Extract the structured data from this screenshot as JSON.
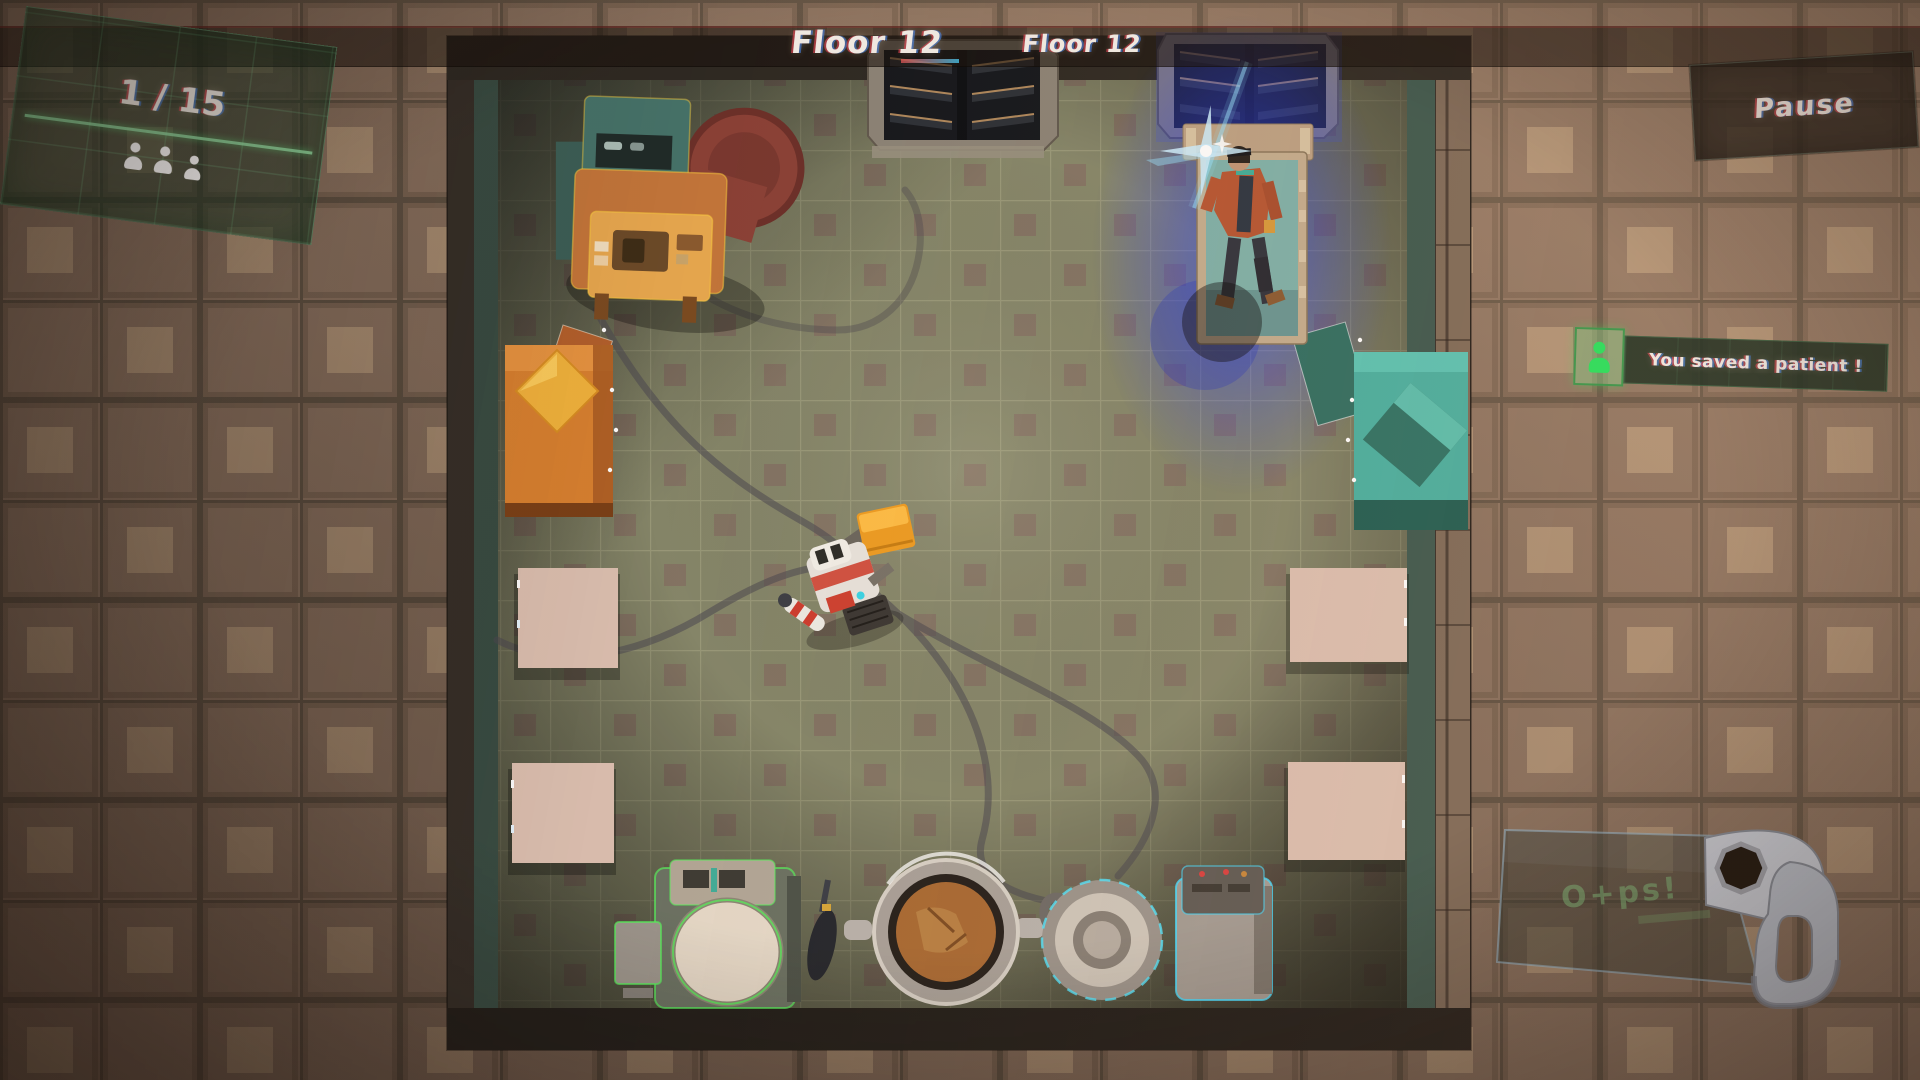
{
  "hud": {
    "top_bar": {
      "floor_label": "Floor 12",
      "floor_label_secondary": "Floor 12"
    },
    "patient_counter": {
      "value": "1 / 15",
      "icon": "person-silhouette",
      "icon_count": 3
    },
    "pause_button": {
      "label": "Pause"
    },
    "notification": {
      "icon": "saved-patient-person",
      "text": "You saved a patient !"
    }
  },
  "scene": {
    "saw_brand": "O+ps!",
    "objects": [
      "elevator-door-top-center",
      "elevator-door-top-right",
      "patient-on-glowing-bed",
      "medical-machine-orange",
      "supply-cabinet-orange",
      "supply-cabinet-teal",
      "operating-table-white-x4",
      "scanner-machine-green-outline",
      "surgical-pot",
      "sterilizer-round-device",
      "monitor-cart-teal-outline",
      "medical-robot-player",
      "bone-saw"
    ]
  },
  "colors": {
    "hud_text": "#f4efe8",
    "hud_green_accent": "#59e07c",
    "notification_bg": "#223c2b",
    "pause_bg": "#2a241d",
    "floor_tile": "#85876a",
    "wall_tile": "#8a7260",
    "glow_blue": "#2c46ff",
    "highlight_yellow": "#ffd23d",
    "highlight_green": "#57f05c",
    "highlight_cyan": "#46e0ff",
    "bed_mattress": "#7eb1a9",
    "cabinet_orange": "#d9812f",
    "cabinet_teal": "#48b0a1"
  }
}
